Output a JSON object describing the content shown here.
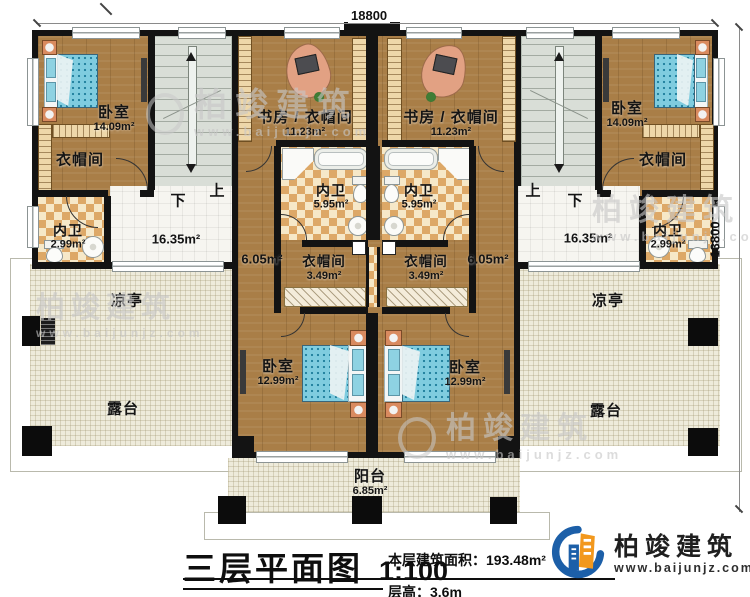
{
  "dimensions": {
    "top": "18800",
    "right": "13800"
  },
  "watermark": {
    "brand": "柏竣建筑",
    "url": "www.baijunjz.com"
  },
  "stairs": {
    "left_down": "下",
    "left_up": "上",
    "right_up": "上",
    "right_down": "下"
  },
  "rooms": {
    "bedroom_top_left": {
      "label": "卧室",
      "area": "14.09m²"
    },
    "closet_top_left": {
      "label": "衣帽间"
    },
    "bath_side_left": {
      "label": "内卫",
      "area": "2.99m²"
    },
    "hall_left": {
      "area": "16.35m²"
    },
    "study_left": {
      "label": "书房 / 衣帽间",
      "area": "11.23m²"
    },
    "bath_inner_left": {
      "label": "内卫",
      "area": "5.95m²"
    },
    "closet_inner_left": {
      "label": "衣帽间",
      "area": "3.49m²"
    },
    "corridor_left": {
      "area": "6.05m²"
    },
    "bedroom_bottom_left": {
      "label": "卧室",
      "area": "12.99m²"
    },
    "pavilion_left": {
      "label": "凉亭"
    },
    "terrace_left": {
      "label": "露台"
    },
    "bedroom_top_right": {
      "label": "卧室",
      "area": "14.09m²"
    },
    "closet_top_right": {
      "label": "衣帽间"
    },
    "bath_side_right": {
      "label": "内卫",
      "area": "2.99m²"
    },
    "hall_right": {
      "area": "16.35m²"
    },
    "study_right": {
      "label": "书房 / 衣帽间",
      "area": "11.23m²"
    },
    "bath_inner_right": {
      "label": "内卫",
      "area": "5.95m²"
    },
    "closet_inner_right": {
      "label": "衣帽间",
      "area": "3.49m²"
    },
    "corridor_right": {
      "area": "6.05m²"
    },
    "bedroom_bottom_right": {
      "label": "卧室",
      "area": "12.99m²"
    },
    "pavilion_right": {
      "label": "凉亭"
    },
    "terrace_right": {
      "label": "露台"
    },
    "balcony": {
      "label": "阳台",
      "area": "6.85m²"
    }
  },
  "titleblock": {
    "title": "三层平面图",
    "scale": "1:100",
    "area_text": "本层建筑面积：193.48m²",
    "floor_height": "层高：3.6m"
  },
  "logo": {
    "brand": "柏竣建筑",
    "url": "www.baijunjz.com"
  },
  "colors": {
    "wall": "#131313",
    "wood": "#a97e47",
    "stair": "#d9ded7",
    "checker": "#dda867",
    "terrace": "#eeebdb",
    "logo_blue": "#1c5fa8",
    "logo_orange": "#f2981d"
  }
}
